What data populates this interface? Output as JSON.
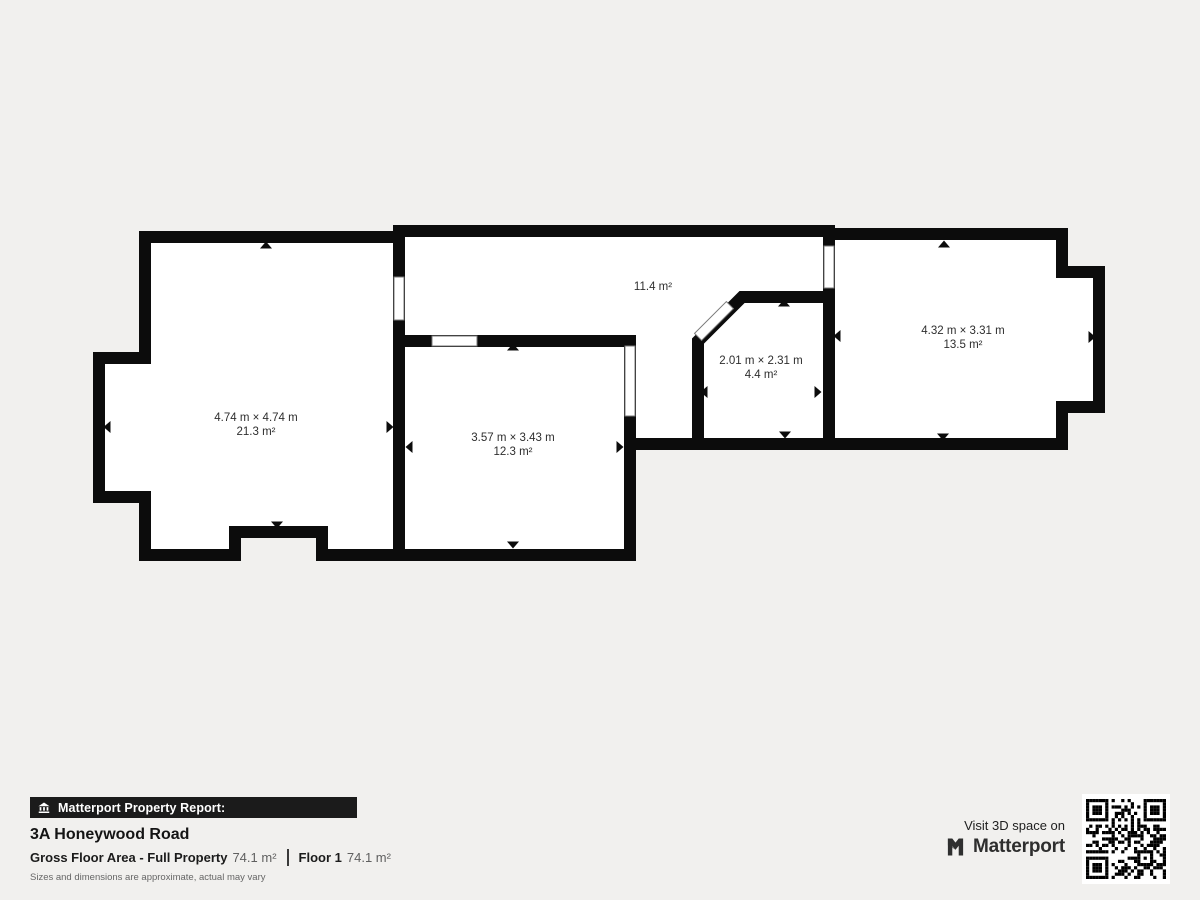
{
  "plan": {
    "rooms": [
      {
        "dimensions": "4.74 m × 4.74 m",
        "area": "21.3 m²"
      },
      {
        "dimensions": "",
        "area": "11.4 m²"
      },
      {
        "dimensions": "3.57 m × 3.43 m",
        "area": "12.3 m²"
      },
      {
        "dimensions": "2.01 m × 2.31 m",
        "area": "4.4 m²"
      },
      {
        "dimensions": "4.32 m × 3.31 m",
        "area": "13.5 m²"
      }
    ]
  },
  "footer": {
    "report_label": "Matterport Property Report:",
    "address": "3A Honeywood Road",
    "gfa_label": "Gross Floor Area - Full Property",
    "gfa_value": "74.1 m²",
    "floor_label": "Floor 1",
    "floor_value": "74.1 m²",
    "disclaimer": "Sizes and dimensions are approximate, actual may vary",
    "visit_text": "Visit 3D space on",
    "brand": "Matterport"
  },
  "icons": {
    "report_bar": "house-icon",
    "brand": "matterport-logo-icon",
    "qr": "qr-code"
  },
  "colors": {
    "background": "#f1f0ee",
    "wall": "#0c0c0c",
    "room_fill": "#ffffff",
    "report_bar_bg": "#1b1b1b",
    "report_bar_text": "#ffffff",
    "label_text": "#2e2e2e",
    "value_text": "#5f5f5f",
    "disclaimer_text": "#666666",
    "brand_text": "#2e2e2e"
  }
}
